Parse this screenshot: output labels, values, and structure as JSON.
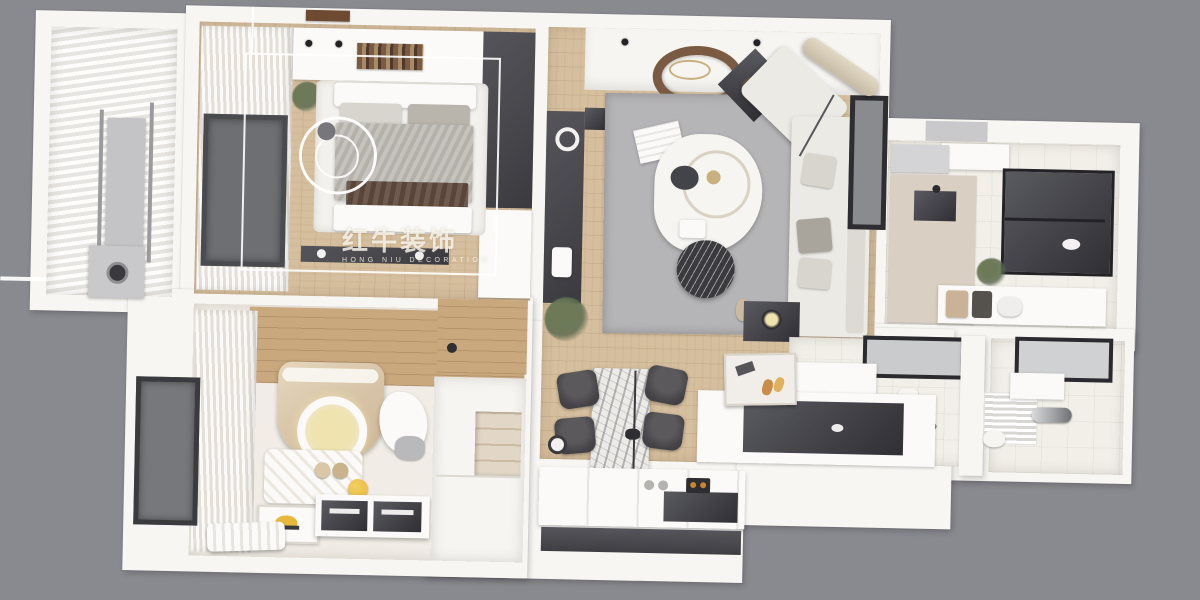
{
  "watermark": {
    "logo_icon": "bull-logo",
    "registered_mark": "®",
    "title": "红牛装饰",
    "subtitle": "HONG NIU DECORATION"
  },
  "scene": {
    "description": "Top-down 3D render of a furnished apartment floor plan on a gray background",
    "rooms": [
      "balcony",
      "master-bedroom",
      "living-room",
      "kitchen",
      "bathroom",
      "second-bathroom",
      "kids-bedroom",
      "closet-corridor",
      "dining-area",
      "entry"
    ]
  },
  "palette": {
    "bg": "#898990",
    "wall": "#F7F6F3",
    "wood": "#D6BF9E",
    "kid-wood": "#C9A87E",
    "floor-pale": "#F1EDE6",
    "tile": "#F2EFE9",
    "rug": "#B5B4B6",
    "dark": "#47474C",
    "sofa": "#ECEAE5",
    "beige": "#D9CFC2",
    "curtain-light": "#FBFAF8",
    "curtain-shade": "#E3DFD7",
    "accent-brown": "#7A5A42",
    "lamp-glow": "#EFE3B0",
    "toy-yellow": "#E8B83C",
    "plant-green": "#5E6B4F",
    "marble-dark": "#3A3A3F"
  }
}
